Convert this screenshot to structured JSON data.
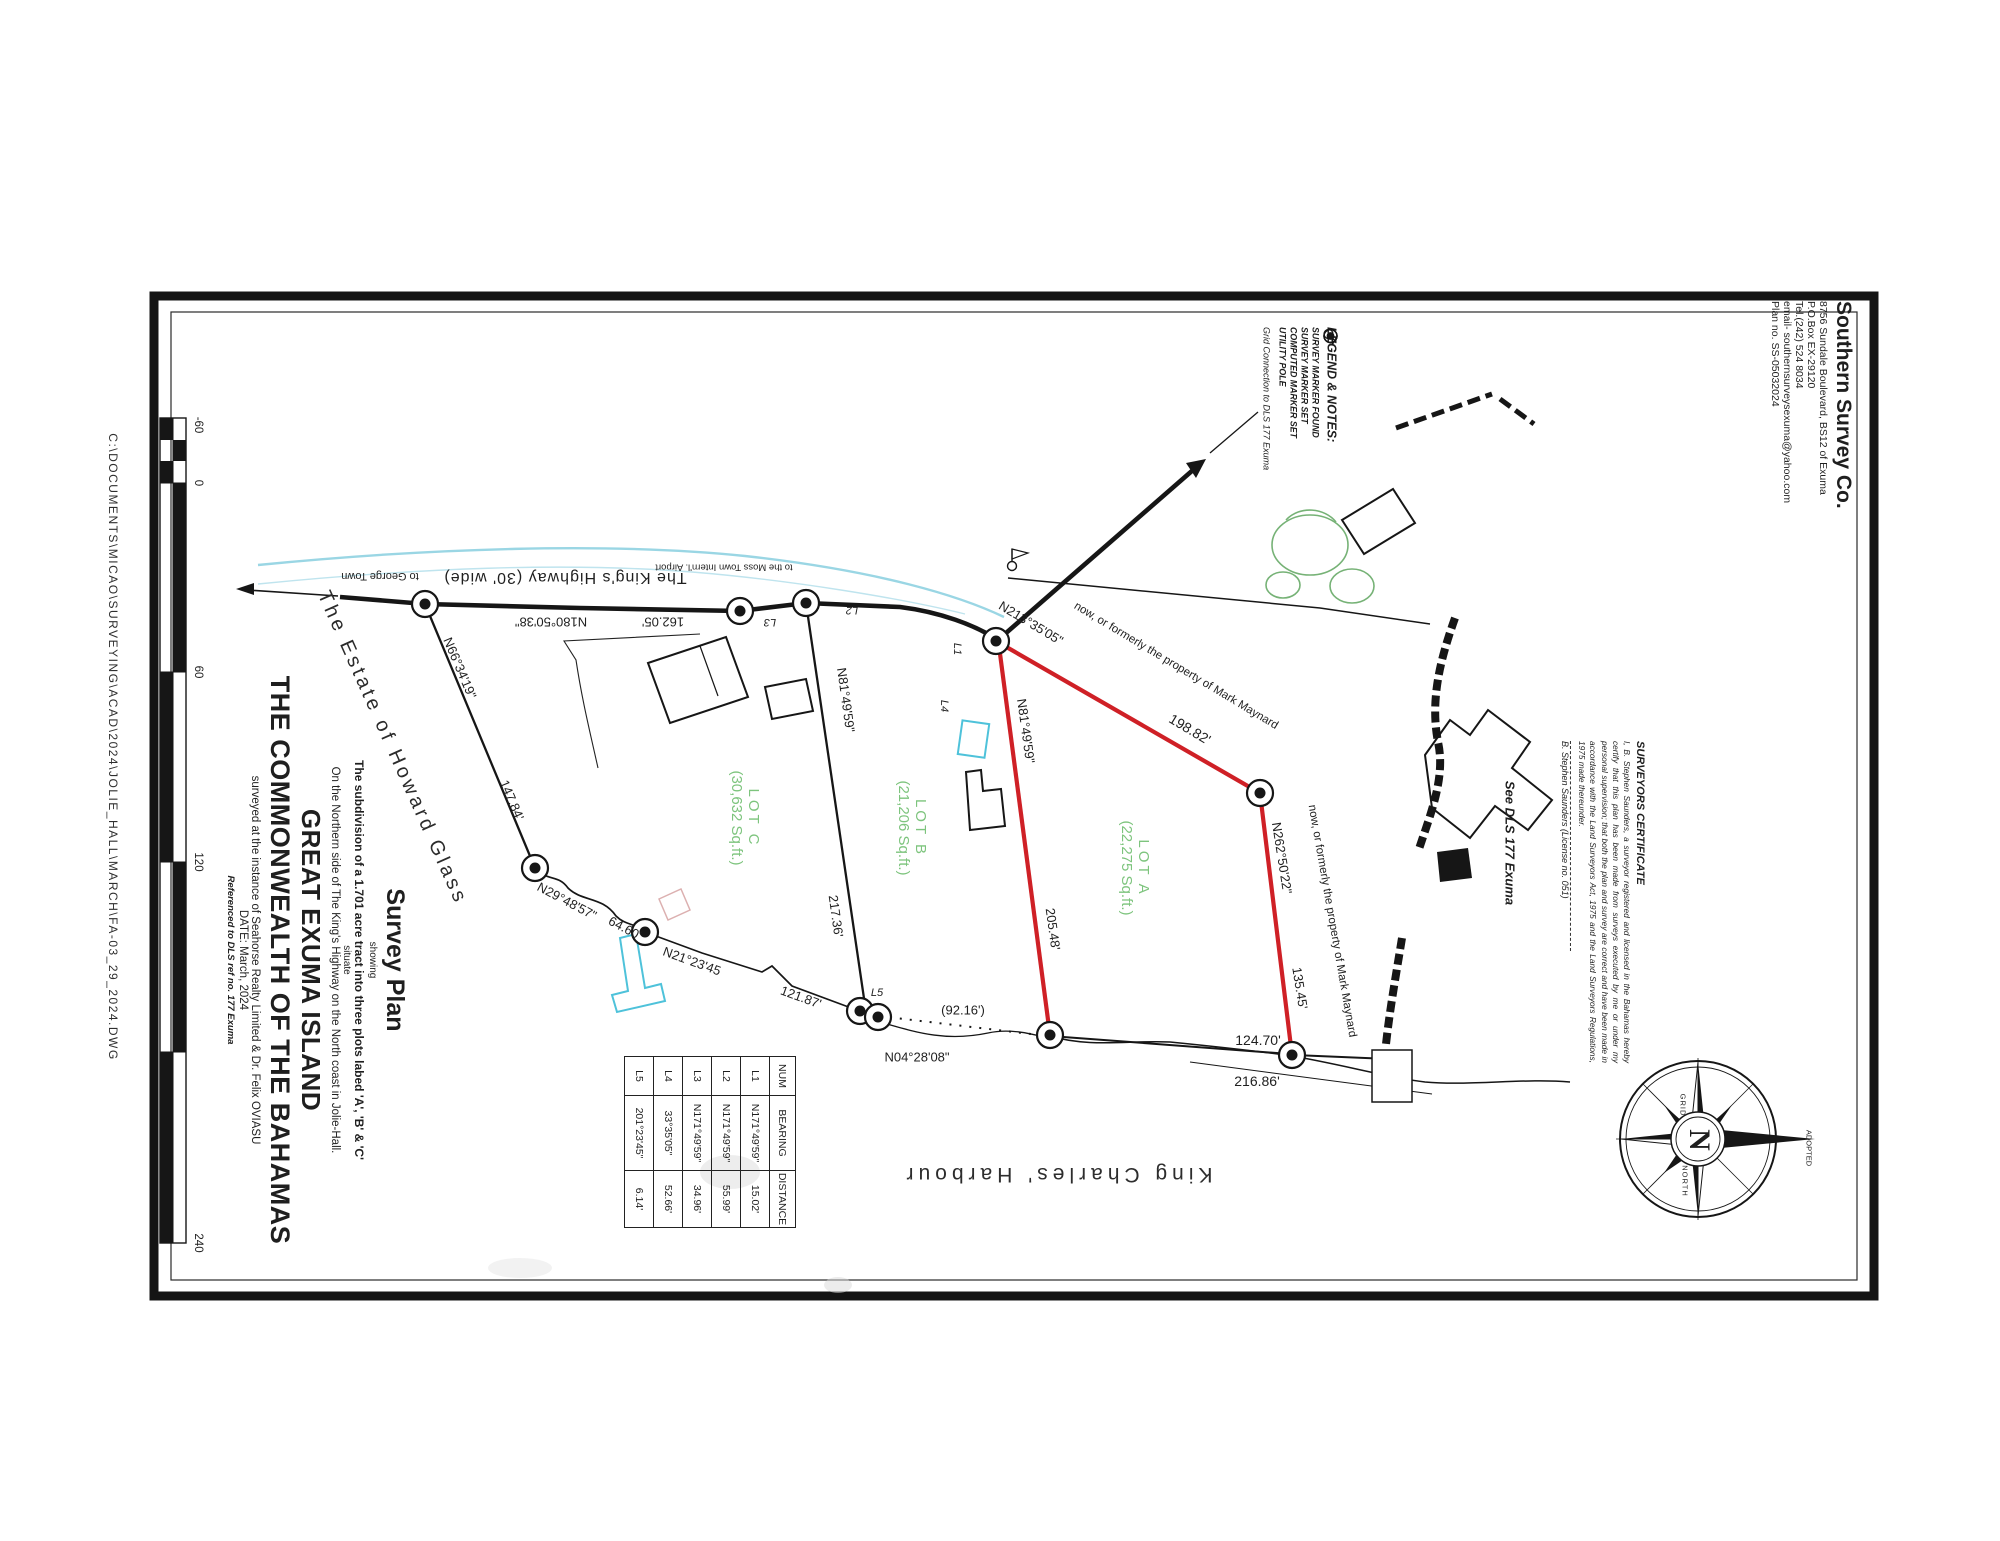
{
  "page": {
    "file_path": "C:\\DOCUMENTS\\MICAO\\SURVEYING\\ACAD\\2024\\JOLIE_HALL\\MARCH\\FA-03_29_2024.DWG"
  },
  "company": {
    "name": "Southern Survey Co.",
    "address": "8756 Sundale Boulevard, BS12 of Exuma",
    "po_box": "P.O.Box EX-29120",
    "tel": "Tel.(242) 524 8034",
    "email": "email- southernsurveysexuma@yahoo.com",
    "plan_no": "Plan no. SS-05032024"
  },
  "legend": {
    "title": "LEGEND & NOTES:",
    "items": [
      {
        "symbol": "survey-marker-found-icon",
        "label": "SURVEY MARKER FOUND"
      },
      {
        "symbol": "survey-marker-set-icon",
        "label": "SURVEY MARKER SET"
      },
      {
        "symbol": "computed-marker-set-icon",
        "label": "COMPUTED MARKER SET"
      },
      {
        "symbol": "utility-pole-icon",
        "label": "UTILITY POLE"
      }
    ],
    "note": "Grid Connection to  DLS 177 Exuma"
  },
  "title_block": {
    "title": "Survey Plan",
    "showing": "showing",
    "subdivision": "The subdivision of a 1.701 acre tract into three plots labed 'A', 'B' & 'C'",
    "situate": "situate",
    "location": "On the Northern side of The King's Highway on the North coast in Jolie-Hall.",
    "island": "GREAT EXUMA ISLAND",
    "country": "THE COMMONWEALTH OF THE BAHAMAS",
    "client": "surveyed at the instance of Seahorse Realty  Limited & Dr. Felix OVIASU",
    "date": "DATE: March, 2024",
    "reference": "Referenced to DLS ref no. 177 Exuma"
  },
  "certificate": {
    "title": "SURVEYORS CERTIFICATE",
    "body": "I, B. Stephen Saunders, a surveyor registered and licensed in the Bahamas hereby certify that this plan has been made from surveys executed by me or under my personal supervision; that both the plan and survey are correct and have been made in accordance with the Land Surveyors Act, 1975 and the Land Surveyors Regulations, 1975 made thereunder.",
    "signature": "B. Stephen Saunders (License no. 051)",
    "see_note": "See DLS 177 Exuma"
  },
  "table": {
    "headers": [
      "NUM",
      "BEARING",
      "DISTANCE"
    ],
    "rows": [
      [
        "L1",
        "N171°49'59\"",
        "15.02'"
      ],
      [
        "L2",
        "N171°49'59\"",
        "55.99'"
      ],
      [
        "L3",
        "N171°49'59\"",
        "34.96'"
      ],
      [
        "L4",
        "33°35'05\"",
        "52.66'"
      ],
      [
        "L5",
        "201°23'45\"",
        "6.14'"
      ]
    ]
  },
  "lots": [
    {
      "name": "LOT C",
      "area": "(30,632  Sq.ft.)"
    },
    {
      "name": "LOT B",
      "area": "(21,206  Sq.ft.)"
    },
    {
      "name": "LOT A",
      "area": "(22,275  Sq.ft.)"
    }
  ],
  "plan": {
    "highway": "The King's Highway (30' wide)",
    "to_george_town": "to George Town",
    "to_airport": "to the Moss Town Intern'l. Airport",
    "road_bearing": "N180°50'38\"",
    "road_distance": "162.05'",
    "west_bearing_1": "N66°34'19\"",
    "west_distance_1": "147.84'",
    "west_bearing_2": "N29°48'57\"",
    "west_distance_2": "64.60'",
    "west_bearing_3": "N21°23'45",
    "west_distance_3": "121.87'",
    "shore_tie_distance": "(92.16')",
    "shore_bearing": "N04°28'08\"",
    "lotc_line_bearing": "N81°49'59\"",
    "lotc_line_distance": "217.36'",
    "lotb_line_bearing": "N81°49'59\"",
    "lotb_line_distance": "205.48'",
    "east_bearing_1": "N213°35'05\"",
    "east_distance_1": "198.82'",
    "east_bearing_2": "N262°50'22\"",
    "east_distance_2": "135.45'",
    "east_distance_3": "124.70'",
    "east_distance_4": "216.86'",
    "neighbor_north": "now, or formerly the property of Mark Maynard",
    "neighbor_east": "now, or formerly the property of Mark Maynard",
    "estate": "The Estate of Howard Glass",
    "harbour": "King Charles' Harbour",
    "markers": {
      "l1": "L1",
      "l2": "L2",
      "l3": "L3",
      "l4": "L4",
      "l5": "L5"
    }
  },
  "compass": {
    "center": "N",
    "grid": "GRID",
    "north": "NORTH",
    "adopted": "ADOPTED"
  },
  "scale_bar": {
    "ticks": [
      "-60",
      "0",
      "60",
      "120",
      "240"
    ]
  }
}
